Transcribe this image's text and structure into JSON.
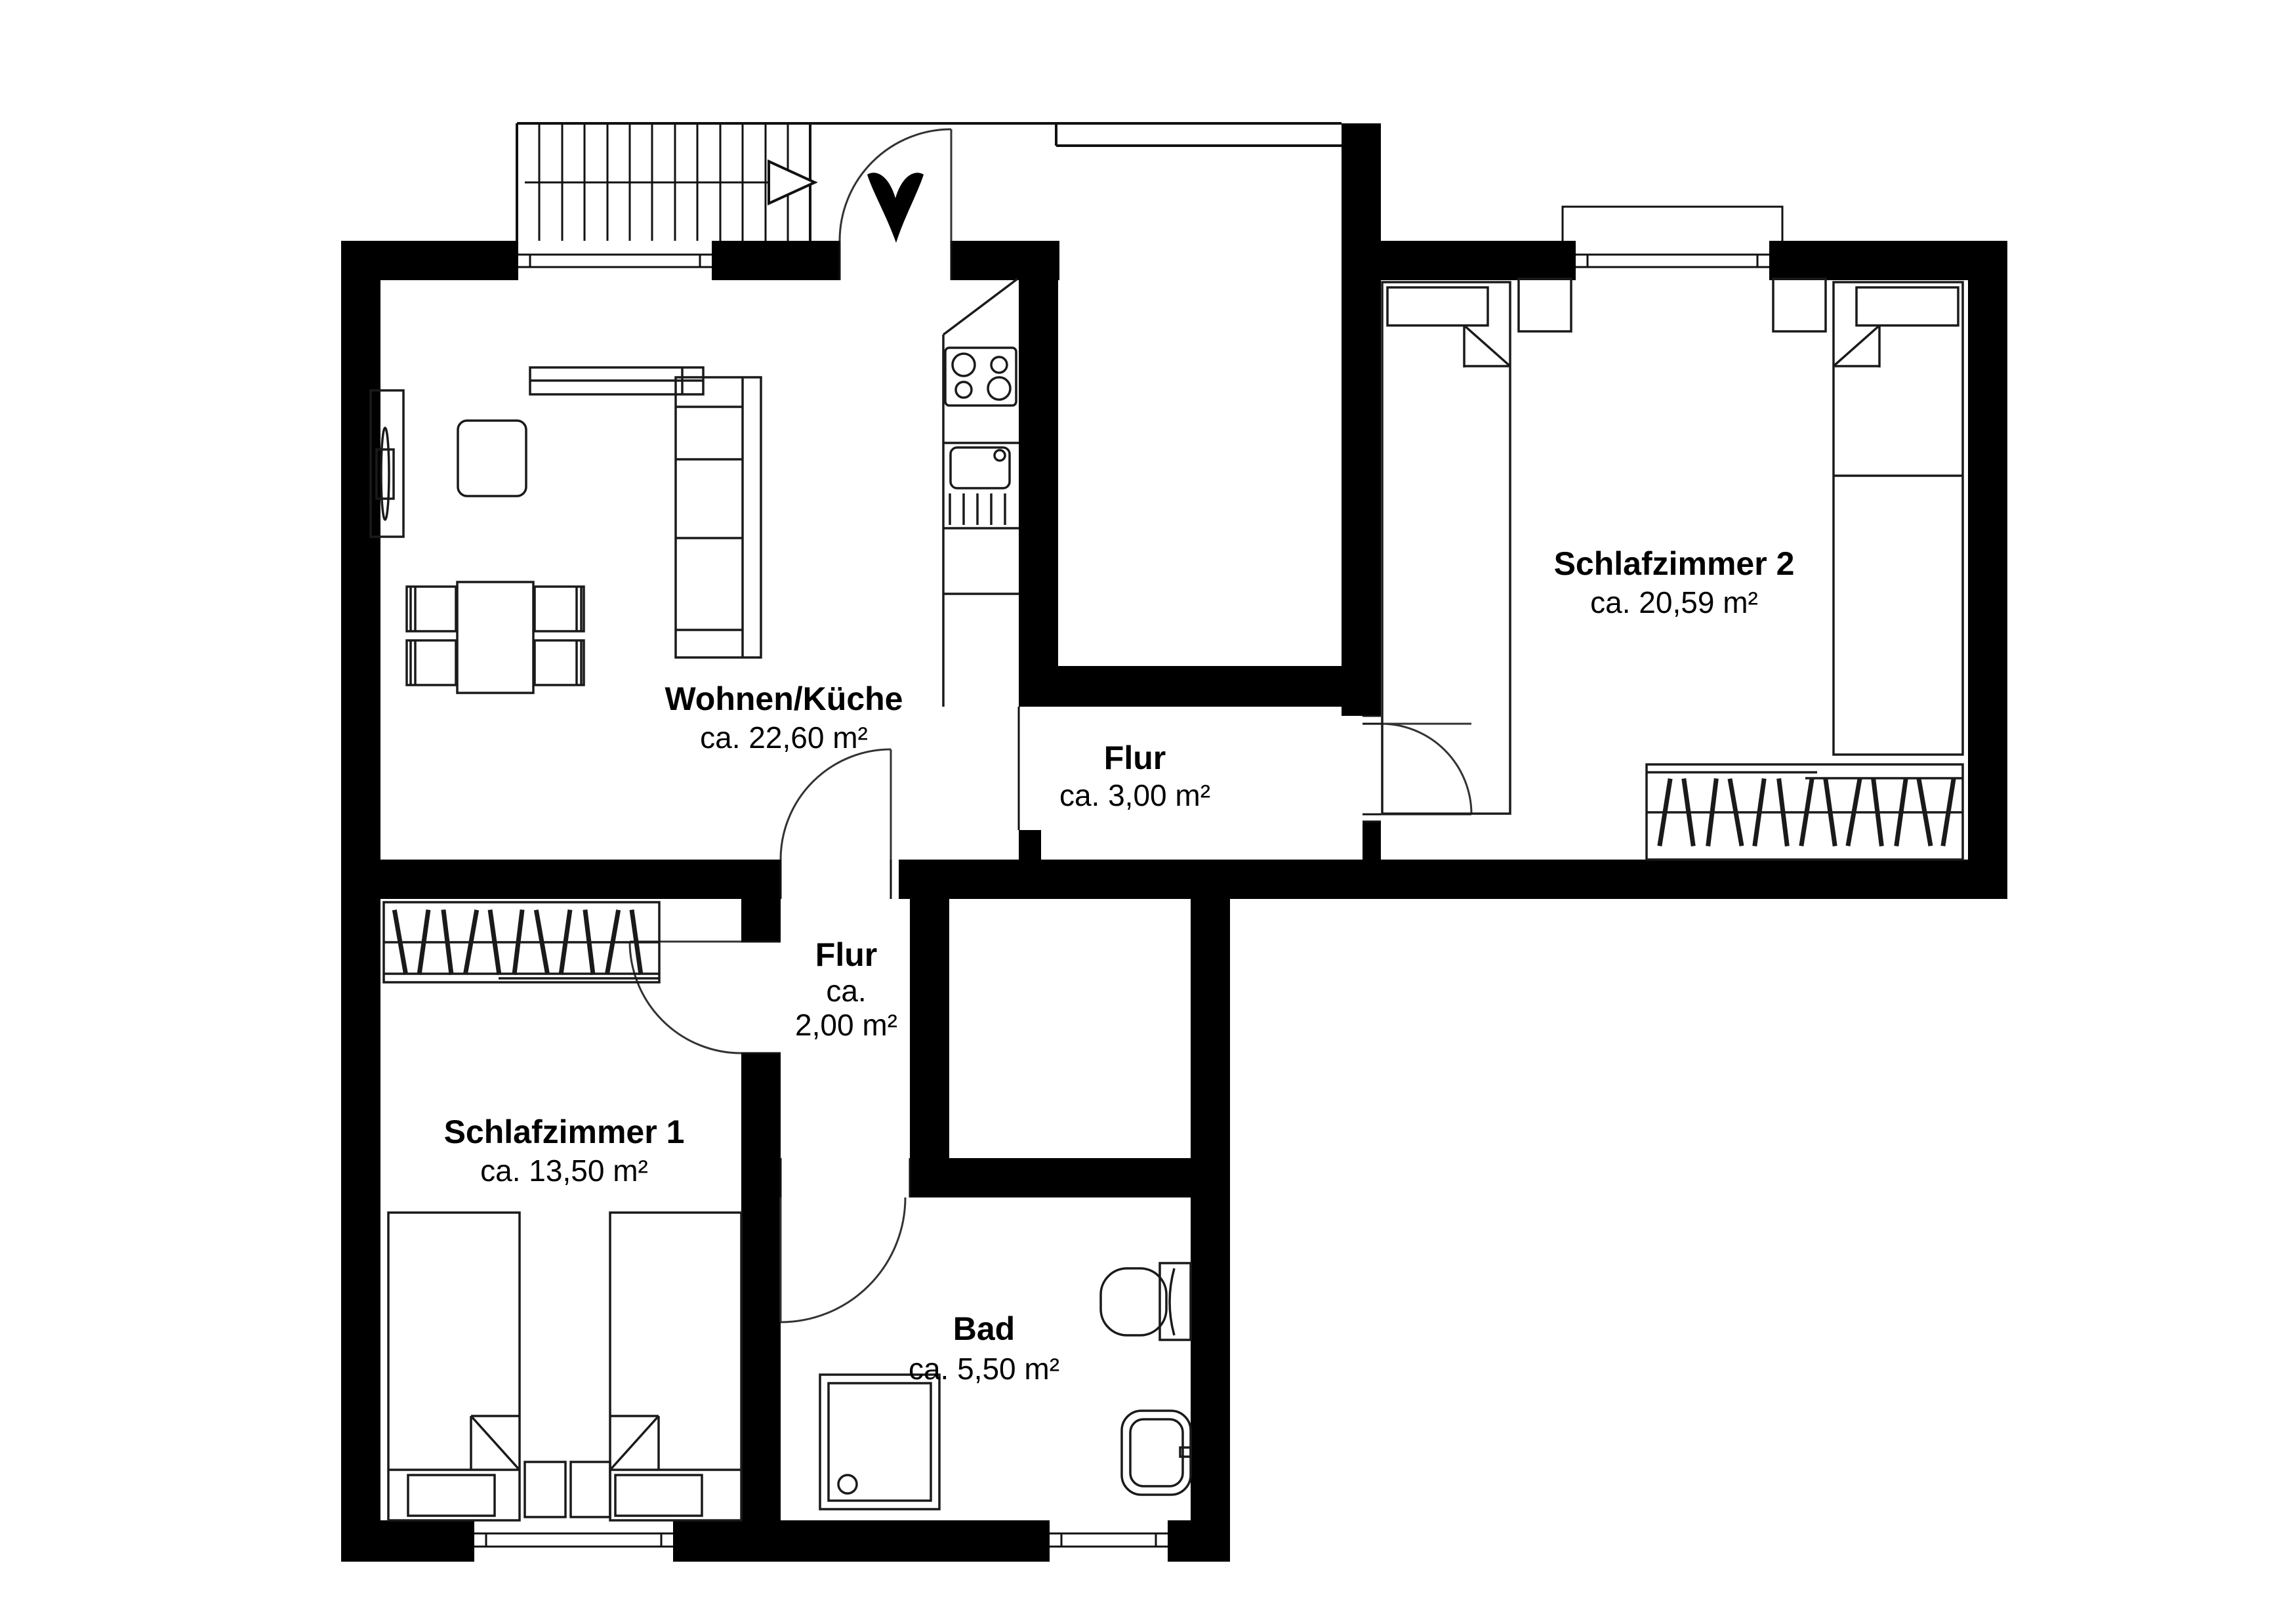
{
  "plan": {
    "background": "#ffffff",
    "wall_color": "#000000",
    "line_color": "#1a1a1a",
    "rooms": [
      {
        "id": "wohnen-kueche",
        "name": "Wohnen/Küche",
        "area": "ca. 22,60 m²"
      },
      {
        "id": "flur-gross",
        "name": "Flur",
        "area": "ca. 3,00 m²"
      },
      {
        "id": "flur-klein",
        "name": "Flur",
        "area_prefix": "ca.",
        "area_value": "2,00 m²"
      },
      {
        "id": "schlafzimmer-1",
        "name": "Schlafzimmer 1",
        "area": "ca. 13,50 m²"
      },
      {
        "id": "bad",
        "name": "Bad",
        "area": "ca. 5,50 m²"
      },
      {
        "id": "schlafzimmer-2",
        "name": "Schlafzimmer 2",
        "area": "ca. 20,59 m²"
      }
    ]
  }
}
